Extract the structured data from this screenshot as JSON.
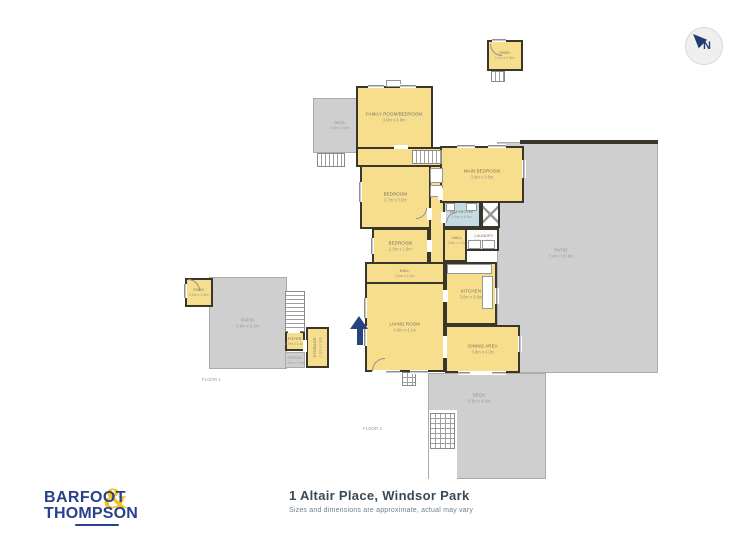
{
  "compass": {
    "letter": "N"
  },
  "floor2": {
    "label": "FLOOR 2",
    "rooms": {
      "family": {
        "name": "FAMILY ROOM/BEDROOM",
        "dims": "3.9m x 4.8m"
      },
      "main_bedroom": {
        "name": "MAIN BEDROOM",
        "dims": "3.8m x 3.6m"
      },
      "bedroom1": {
        "name": "BEDROOM",
        "dims": "2.7m x 3.6m"
      },
      "bedroom2": {
        "name": "BEDROOM",
        "dims": "2.6m x 1.9m"
      },
      "bathroom": {
        "name": "BATHROOM",
        "dims": "2.6m x 1.9m"
      },
      "laundry": {
        "name": "LAUNDRY",
        "dims": "1.9m x 1.6m"
      },
      "hall_upper": {
        "name": "HALL",
        "dims": "2.6m x 1.0m"
      },
      "hall": {
        "name": "HALL",
        "dims": "4.6m x 1.0m"
      },
      "kitchen": {
        "name": "KITCHEN",
        "dims": "3.0m x 3.8m"
      },
      "living": {
        "name": "LIVING ROOM",
        "dims": "4.8m x 4.1m"
      },
      "dining": {
        "name": "DINING AREA",
        "dims": "3.8m x 4.2m"
      },
      "shed": {
        "name": "SHED",
        "dims": "2.1m x 1.8m"
      },
      "deck_upper": {
        "name": "DECK",
        "dims": "3.0m x 2.5m"
      },
      "patio": {
        "name": "PATIO",
        "dims": "7.4m x 10.6m"
      },
      "deck": {
        "name": "DECK",
        "dims": "5.3m x 4.6m"
      }
    }
  },
  "floor1": {
    "label": "FLOOR 1",
    "rooms": {
      "shed": {
        "name": "SHED",
        "dims": "2.0m x 1.9m"
      },
      "patio": {
        "name": "PATIO",
        "dims": "4.8m x 4.1m"
      },
      "foyer": {
        "name": "FOYER",
        "dims": "2.0m x 1.1m"
      },
      "storage": {
        "name": "STORAGE",
        "dims": "1.1m x 2.9m"
      },
      "porch": {
        "name": "PORCH",
        "dims": "2.0m x 1.0m"
      }
    }
  },
  "footer": {
    "brand_top": "BARFOOT",
    "brand_amp": "&",
    "brand_bottom": "THOMPSON",
    "address": "1 Altair Place, Windsor Park",
    "disclaimer": "Sizes and dimensions are approximate, actual may vary"
  },
  "colors": {
    "room_fill": "#F6DE8D",
    "wall": "#3A362C",
    "outdoor_fill": "#CFCFCF",
    "bathroom_fill": "#C5DBE3",
    "brand_navy": "#27418A",
    "brand_yellow": "#F2C41B",
    "title_color": "#3A4A55"
  }
}
